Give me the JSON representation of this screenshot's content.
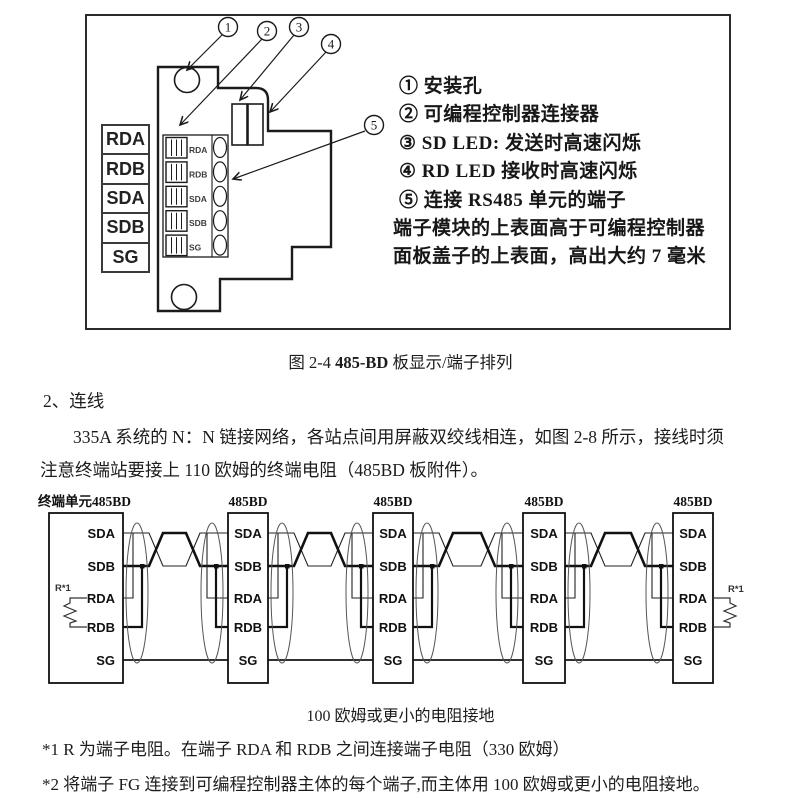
{
  "colors": {
    "ink": "#1a1a1a",
    "line": "#1b1b1b"
  },
  "figure_board": {
    "legend": [
      "RDA",
      "RDB",
      "SDA",
      "SDB",
      "SG"
    ],
    "block_labels": [
      "RDA",
      "RDB",
      "SDA",
      "SDB",
      "SG"
    ],
    "callouts": [
      "1",
      "2",
      "3",
      "4",
      "5"
    ],
    "notes": [
      "① 安装孔",
      "② 可编程控制器连接器",
      "③ SD LED: 发送时高速闪烁",
      "④ RD LED 接收时高速闪烁",
      "⑤ 连接 RS485 单元的端子",
      "端子模块的上表面高于可编程控制器",
      "面板盖子的上表面，高出大约 7 毫米"
    ]
  },
  "caption_fig": {
    "prefix": "图 2-4 ",
    "bold": "485-BD",
    "suffix": " 板显示/端子排列"
  },
  "section": {
    "heading": "2、连线",
    "line1": "335A 系统的 N：N 链接网络，各站点间用屏蔽双绞线相连，如图 2-8 所示，接线时须",
    "line2": "注意终端站要接上 110 欧姆的终端电阻（485BD 板附件）。"
  },
  "figure_wiring": {
    "units": [
      {
        "title": "终端单元485BD",
        "terminals": [
          "SDA",
          "SDB",
          "RDA",
          "RDB",
          "SG"
        ]
      },
      {
        "title": "485BD",
        "terminals": [
          "SDA",
          "SDB",
          "RDA",
          "RDB",
          "SG"
        ]
      },
      {
        "title": "485BD",
        "terminals": [
          "SDA",
          "SDB",
          "RDA",
          "RDB",
          "SG"
        ]
      },
      {
        "title": "485BD",
        "terminals": [
          "SDA",
          "SDB",
          "RDA",
          "RDB",
          "SG"
        ]
      },
      {
        "title": "485BD",
        "terminals": [
          "SDA",
          "SDB",
          "RDA",
          "RDB",
          "SG"
        ]
      }
    ],
    "resistor_label_left": "R*1",
    "resistor_label_right": "R*1",
    "caption": "100 欧姆或更小的电阻接地"
  },
  "footnotes": [
    "*1 R 为端子电阻。在端子 RDA 和 RDB 之间连接端子电阻（330 欧姆）",
    "*2 将端子 FG 连接到可编程控制器主体的每个端子,而主体用 100 欧姆或更小的电阻接地。"
  ]
}
